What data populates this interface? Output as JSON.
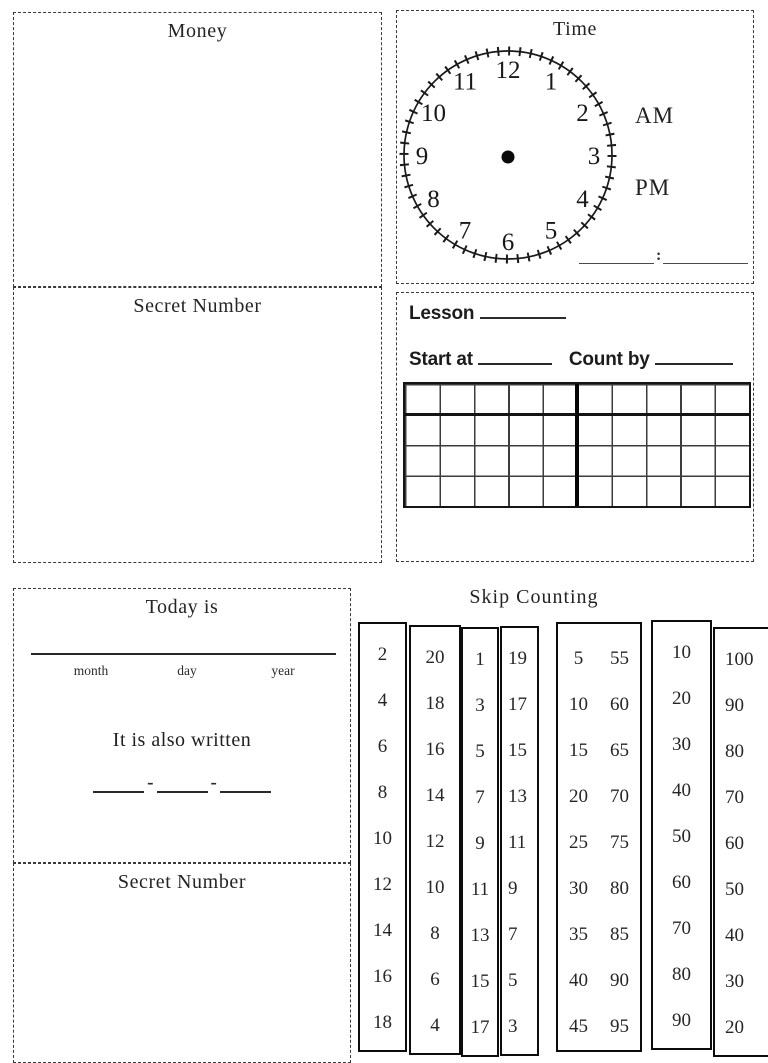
{
  "money": {
    "title": "Money"
  },
  "secret_number_top": {
    "title": "Secret Number"
  },
  "time": {
    "title": "Time",
    "clock_numbers": [
      "12",
      "1",
      "2",
      "3",
      "4",
      "5",
      "6",
      "7",
      "8",
      "9",
      "10",
      "11"
    ],
    "am_label": "AM",
    "pm_label": "PM",
    "separator": ":"
  },
  "lesson": {
    "lesson_label": "Lesson",
    "start_at_label": "Start at",
    "count_by_label": "Count by",
    "grid_rows": 4,
    "grid_cols": 10
  },
  "today": {
    "title": "Today is",
    "month_label": "month",
    "day_label": "day",
    "year_label": "year",
    "also_written": "It is also written",
    "hyphen": "-"
  },
  "secret_number_bottom": {
    "title": "Secret Number"
  },
  "skip_counting": {
    "title": "Skip Counting",
    "columns": [
      {
        "name": "twos-up",
        "values": [
          "2",
          "4",
          "6",
          "8",
          "10",
          "12",
          "14",
          "16",
          "18"
        ]
      },
      {
        "name": "twos-down",
        "values": [
          "20",
          "18",
          "16",
          "14",
          "12",
          "10",
          "8",
          "6",
          "4"
        ]
      },
      {
        "name": "odds-up",
        "values": [
          "1",
          "3",
          "5",
          "7",
          "9",
          "11",
          "13",
          "15",
          "17"
        ]
      },
      {
        "name": "odds-down",
        "values": [
          "19",
          "17",
          "15",
          "13",
          "11",
          "9",
          "7",
          "5",
          "3"
        ]
      },
      {
        "name": "fives-pairs",
        "pairs": [
          [
            "5",
            "55"
          ],
          [
            "10",
            "60"
          ],
          [
            "15",
            "65"
          ],
          [
            "20",
            "70"
          ],
          [
            "25",
            "75"
          ],
          [
            "30",
            "80"
          ],
          [
            "35",
            "85"
          ],
          [
            "40",
            "90"
          ],
          [
            "45",
            "95"
          ]
        ]
      },
      {
        "name": "tens-up",
        "values": [
          "10",
          "20",
          "30",
          "40",
          "50",
          "60",
          "70",
          "80",
          "90"
        ]
      },
      {
        "name": "tens-down",
        "values": [
          "100",
          "90",
          "80",
          "70",
          "60",
          "50",
          "40",
          "30",
          "20"
        ]
      }
    ]
  }
}
